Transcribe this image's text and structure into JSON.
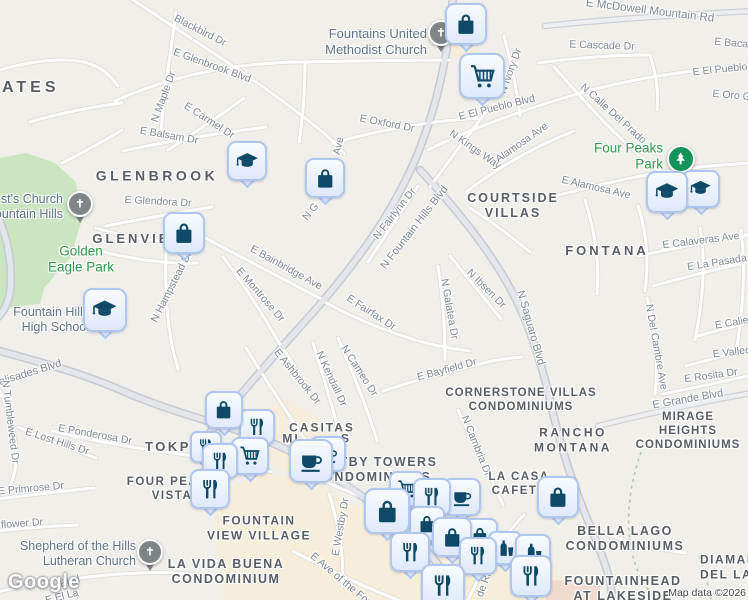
{
  "map": {
    "attribution": {
      "logo": "Google",
      "map_data": "Map data ©2026"
    },
    "colors": {
      "background": "#F0EFEA",
      "road_minor_fill": "#FFFFFF",
      "road_major_fill": "#E3E6EA",
      "road_casing": "#C6CAD1",
      "park_fill": "#CAE5C0",
      "commercial_fill": "#F6EEDB",
      "marker_fill": "#E9F0FC",
      "marker_border": "#AFC6F0",
      "marker_glyph": "#0E4A68",
      "church_pin": "#7F8487",
      "park_pin": "#12945B",
      "park_label": "#2E9A48",
      "poi_label": "#5E7487",
      "road_label": "#7E8995",
      "area_label": "#575D64"
    },
    "area_labels": [
      {
        "id": "estates",
        "text": "ATES",
        "x": 2,
        "y": 88,
        "size": 16,
        "ls": 4,
        "align": "left"
      },
      {
        "id": "glenbrook",
        "text": "GLENBROOK",
        "x": 157,
        "y": 176,
        "size": 14,
        "ls": 3.5
      },
      {
        "id": "glenview",
        "text": "GLENVIEW",
        "x": 139,
        "y": 239,
        "size": 13,
        "ls": 3
      },
      {
        "id": "courtside-villas",
        "text": "COURTSIDE\nVILLAS",
        "x": 513,
        "y": 206,
        "size": 12.5,
        "ls": 2
      },
      {
        "id": "fontana",
        "text": "FONTANA",
        "x": 607,
        "y": 251,
        "size": 13,
        "ls": 3
      },
      {
        "id": "cornerstone-villas-condominiums",
        "text": "CORNERSTONE VILLAS\nCONDOMINIUMS",
        "x": 521,
        "y": 400,
        "size": 11.5,
        "ls": 1
      },
      {
        "id": "rancho-montana",
        "text": "RANCHO\nMONTANA",
        "x": 573,
        "y": 440,
        "size": 12,
        "ls": 2.5
      },
      {
        "id": "mirage-heights-condominiums",
        "text": "MIRAGE HEIGHTS\nCONDOMINIUMS",
        "x": 688,
        "y": 431,
        "size": 11.5,
        "ls": 1
      },
      {
        "id": "la-casa-cafeta",
        "text": "LA CASA\nCAFETA",
        "x": 519,
        "y": 484,
        "size": 11.5,
        "ls": 1.5
      },
      {
        "id": "casitas",
        "text": "CASITAS",
        "x": 322,
        "y": 428,
        "size": 12,
        "ls": 2
      },
      {
        "id": "casitas-frag-mi",
        "text": "MI",
        "x": 291,
        "y": 439,
        "size": 12,
        "ls": 2
      },
      {
        "id": "casitas-frag-s",
        "text": "S",
        "x": 346,
        "y": 439,
        "size": 12,
        "ls": 2
      },
      {
        "id": "westby-towers-condominiums",
        "text": "WESTBY TOWERS\nCONDOMINIUMS",
        "x": 372,
        "y": 470,
        "size": 12.5,
        "ls": 1.5
      },
      {
        "id": "tokpe",
        "text": "TOKPE",
        "x": 145,
        "y": 447,
        "size": 13,
        "ls": 2.5,
        "align": "left"
      },
      {
        "id": "four-peaks-vista",
        "text": "FOUR PEAKS\nVISTA",
        "x": 172,
        "y": 489,
        "size": 11.5,
        "ls": 1.5
      },
      {
        "id": "fountain-view-village",
        "text": "FOUNTAIN\nVIEW VILLAGE",
        "x": 259,
        "y": 528,
        "size": 12,
        "ls": 1.5
      },
      {
        "id": "la-vida-buena-condominium",
        "text": "LA VIDA BUENA\nCONDOMINIUM",
        "x": 226,
        "y": 572,
        "size": 12.5,
        "ls": 1.5
      },
      {
        "id": "bella-lago-condominiums",
        "text": "BELLA LAGO\nCONDOMINIUMS",
        "x": 625,
        "y": 539,
        "size": 12.5,
        "ls": 1.5
      },
      {
        "id": "diamante-del-lago",
        "text": "DIAMANTE\nDEL LAGO",
        "x": 700,
        "y": 567,
        "size": 12,
        "ls": 1.5,
        "align": "left"
      },
      {
        "id": "fountainhead-at-lakeside",
        "text": "FOUNTAINHEAD\nAT LAKESIDE",
        "x": 623,
        "y": 589,
        "size": 12.5,
        "ls": 1.5
      }
    ],
    "road_labels": [
      {
        "text": "Blackbird Dr",
        "x": 200,
        "y": 31,
        "rot": 27
      },
      {
        "text": "E Glenbrook Blvd",
        "x": 212,
        "y": 66,
        "rot": 20
      },
      {
        "text": "N Maple Dr",
        "x": 164,
        "y": 97,
        "rot": -70
      },
      {
        "text": "E Carmel Dr",
        "x": 209,
        "y": 121,
        "rot": 33
      },
      {
        "text": "E Balsam Dr",
        "x": 169,
        "y": 136,
        "rot": 10
      },
      {
        "text": "E Glendora Dr",
        "x": 158,
        "y": 202,
        "rot": 3
      },
      {
        "text": "E McDowell Mountain Rd",
        "x": 650,
        "y": 11,
        "rot": 7,
        "size": 11.5
      },
      {
        "text": "E Cascade Dr",
        "x": 602,
        "y": 46,
        "rot": 2
      },
      {
        "text": "E Bacana",
        "x": 737,
        "y": 44,
        "rot": 5
      },
      {
        "text": "E El Pueblo",
        "x": 720,
        "y": 70,
        "rot": -6
      },
      {
        "text": "E Oro Grande",
        "x": 745,
        "y": 97,
        "rot": 5
      },
      {
        "text": "N Ivory Dr",
        "x": 511,
        "y": 71,
        "rot": -70
      },
      {
        "text": "E El Pueblo Blvd",
        "x": 497,
        "y": 108,
        "rot": -14
      },
      {
        "text": "N Kings Way",
        "x": 475,
        "y": 150,
        "rot": 35
      },
      {
        "text": "N Calle Del Prado",
        "x": 613,
        "y": 114,
        "rot": 42
      },
      {
        "text": "Alamosa Ave",
        "x": 522,
        "y": 143,
        "rot": -35
      },
      {
        "text": "E Alamosa Ave",
        "x": 596,
        "y": 188,
        "rot": 13
      },
      {
        "text": "E Oxford Dr",
        "x": 387,
        "y": 124,
        "rot": 11
      },
      {
        "text": "N Fairlynn Dr",
        "x": 395,
        "y": 214,
        "rot": -52
      },
      {
        "text": "N Fountain Hills Blvd",
        "x": 415,
        "y": 228,
        "rot": -52,
        "size": 11
      },
      {
        "text": "E Bainbridge Ave",
        "x": 286,
        "y": 268,
        "rot": 29
      },
      {
        "text": "E Montrose Dr",
        "x": 260,
        "y": 295,
        "rot": 49
      },
      {
        "text": "N Hampstead Dr",
        "x": 172,
        "y": 287,
        "rot": -63
      },
      {
        "text": "E Fairfax Dr",
        "x": 371,
        "y": 313,
        "rot": 33
      },
      {
        "text": "N Galatea Dr",
        "x": 449,
        "y": 309,
        "rot": 80
      },
      {
        "text": "N Ibsen Dr",
        "x": 486,
        "y": 289,
        "rot": 45
      },
      {
        "text": "N Saguaro Blvd",
        "x": 530,
        "y": 328,
        "rot": 74,
        "size": 11
      },
      {
        "text": "N Del Cambre Ave",
        "x": 656,
        "y": 347,
        "rot": 80
      },
      {
        "text": "E Calaveras Ave",
        "x": 701,
        "y": 241,
        "rot": -7
      },
      {
        "text": "E La Pasada",
        "x": 717,
        "y": 263,
        "rot": -9
      },
      {
        "text": "E Caliente",
        "x": 739,
        "y": 322,
        "rot": -10
      },
      {
        "text": "E Vallecito",
        "x": 737,
        "y": 352,
        "rot": -7
      },
      {
        "text": "E Rosita Dr",
        "x": 711,
        "y": 376,
        "rot": -8
      },
      {
        "text": "E Grande Blvd",
        "x": 688,
        "y": 400,
        "rot": -10,
        "size": 11
      },
      {
        "text": "E Palisades Blvd",
        "x": 22,
        "y": 376,
        "rot": -17,
        "size": 11
      },
      {
        "text": "N Tumbleweed Dr",
        "x": 10,
        "y": 422,
        "rot": 83
      },
      {
        "text": "E Lost Hills Dr",
        "x": 57,
        "y": 442,
        "rot": 18
      },
      {
        "text": "E Ponderosa Dr",
        "x": 95,
        "y": 435,
        "rot": 10
      },
      {
        "text": "E Primrose Dr",
        "x": 31,
        "y": 489,
        "rot": -5
      },
      {
        "text": "flower Dr",
        "x": 22,
        "y": 524,
        "rot": -4
      },
      {
        "text": "Blvd",
        "x": 70,
        "y": 582,
        "rot": -16
      },
      {
        "text": "E El La",
        "x": 62,
        "y": 597,
        "rot": -14
      },
      {
        "text": "E Westby Dr",
        "x": 341,
        "y": 527,
        "rot": -80
      },
      {
        "text": "E Ave of the Fountains",
        "x": 352,
        "y": 589,
        "rot": 40
      },
      {
        "text": "N Cambria Dr",
        "x": 476,
        "y": 446,
        "rot": 68
      },
      {
        "text": "de Rive",
        "x": 486,
        "y": 580,
        "rot": -70
      },
      {
        "text": "Ave",
        "x": 339,
        "y": 146,
        "rot": -78
      },
      {
        "text": "N G",
        "x": 311,
        "y": 212,
        "rot": -50
      },
      {
        "text": "N Cameo Dr",
        "x": 359,
        "y": 371,
        "rot": 57
      },
      {
        "text": "N Kendall Dr",
        "x": 331,
        "y": 379,
        "rot": 65
      },
      {
        "text": "E Ashbrook Dr",
        "x": 297,
        "y": 377,
        "rot": 51
      },
      {
        "text": "E Bayfield Dr",
        "x": 447,
        "y": 370,
        "rot": -15
      }
    ],
    "poi_labels": [
      {
        "id": "fountains-united-methodist-church",
        "text": "Fountains United\nMethodist Church",
        "x": 427,
        "y": 42,
        "align": "right",
        "kind": "church",
        "size": 13
      },
      {
        "id": "christs-church-fountain-hills",
        "text": "st's Church\nountain Hills",
        "x": 63,
        "y": 207,
        "align": "right",
        "kind": "church",
        "size": 12.5
      },
      {
        "id": "fountain-hills-high-school",
        "text": "Fountain Hills\nHigh School",
        "x": 89,
        "y": 320,
        "align": "right",
        "kind": "church",
        "size": 12.5
      },
      {
        "id": "shepherd-of-the-hills-lutheran-church",
        "text": "Shepherd of the Hills\nLutheran Church",
        "x": 136,
        "y": 554,
        "align": "right",
        "kind": "church",
        "size": 12.5
      },
      {
        "id": "golden-eagle-park",
        "text": "Golden\nEagle Park",
        "x": 81,
        "y": 260,
        "align": "center",
        "kind": "park",
        "size": 13.5
      },
      {
        "id": "four-peaks-park",
        "text": "Four Peaks Park",
        "x": 663,
        "y": 157,
        "align": "right",
        "kind": "park",
        "size": 13.5
      }
    ],
    "markers": [
      {
        "t": "church",
        "x": 441,
        "y": 33
      },
      {
        "t": "shopping-bag",
        "x": 466,
        "y": 24,
        "s": 42
      },
      {
        "t": "shopping-cart",
        "x": 482,
        "y": 76,
        "s": 46
      },
      {
        "t": "school",
        "x": 247,
        "y": 161,
        "s": 40
      },
      {
        "t": "shopping-bag",
        "x": 325,
        "y": 178,
        "s": 40
      },
      {
        "t": "park",
        "x": 681,
        "y": 159
      },
      {
        "t": "school",
        "x": 701,
        "y": 189,
        "s": 38
      },
      {
        "t": "school",
        "x": 667,
        "y": 192,
        "s": 42
      },
      {
        "t": "church",
        "x": 80,
        "y": 204
      },
      {
        "t": "shopping-bag",
        "x": 184,
        "y": 233,
        "s": 42
      },
      {
        "t": "school",
        "x": 105,
        "y": 310,
        "s": 44
      },
      {
        "t": "restaurant",
        "x": 257,
        "y": 427,
        "s": 36
      },
      {
        "t": "shopping-bag",
        "x": 224,
        "y": 410,
        "s": 38
      },
      {
        "t": "restaurant",
        "x": 206,
        "y": 447,
        "s": 32
      },
      {
        "t": "shopping-cart",
        "x": 250,
        "y": 456,
        "s": 38
      },
      {
        "t": "restaurant",
        "x": 220,
        "y": 461,
        "s": 36
      },
      {
        "t": "restaurant",
        "x": 210,
        "y": 489,
        "s": 40
      },
      {
        "t": "cafe",
        "x": 328,
        "y": 454,
        "s": 36
      },
      {
        "t": "cafe",
        "x": 311,
        "y": 461,
        "s": 44
      },
      {
        "t": "shopping-bag",
        "x": 558,
        "y": 497,
        "s": 42
      },
      {
        "t": "cafe",
        "x": 462,
        "y": 497,
        "s": 38
      },
      {
        "t": "shopping-cart",
        "x": 407,
        "y": 489,
        "s": 36
      },
      {
        "t": "restaurant",
        "x": 432,
        "y": 497,
        "s": 38
      },
      {
        "t": "shopping-bag",
        "x": 427,
        "y": 524,
        "s": 36
      },
      {
        "t": "shopping-bag",
        "x": 387,
        "y": 511,
        "s": 46
      },
      {
        "t": "shopping-bag",
        "x": 480,
        "y": 536,
        "s": 36
      },
      {
        "t": "shopping-bag",
        "x": 452,
        "y": 537,
        "s": 40
      },
      {
        "t": "bar",
        "x": 505,
        "y": 548,
        "s": 34
      },
      {
        "t": "bar",
        "x": 533,
        "y": 552,
        "s": 36
      },
      {
        "t": "restaurant",
        "x": 410,
        "y": 552,
        "s": 40
      },
      {
        "t": "restaurant",
        "x": 478,
        "y": 556,
        "s": 38
      },
      {
        "t": "restaurant",
        "x": 531,
        "y": 576,
        "s": 42
      },
      {
        "t": "restaurant",
        "x": 443,
        "y": 586,
        "s": 44
      },
      {
        "t": "church",
        "x": 150,
        "y": 552
      }
    ]
  }
}
